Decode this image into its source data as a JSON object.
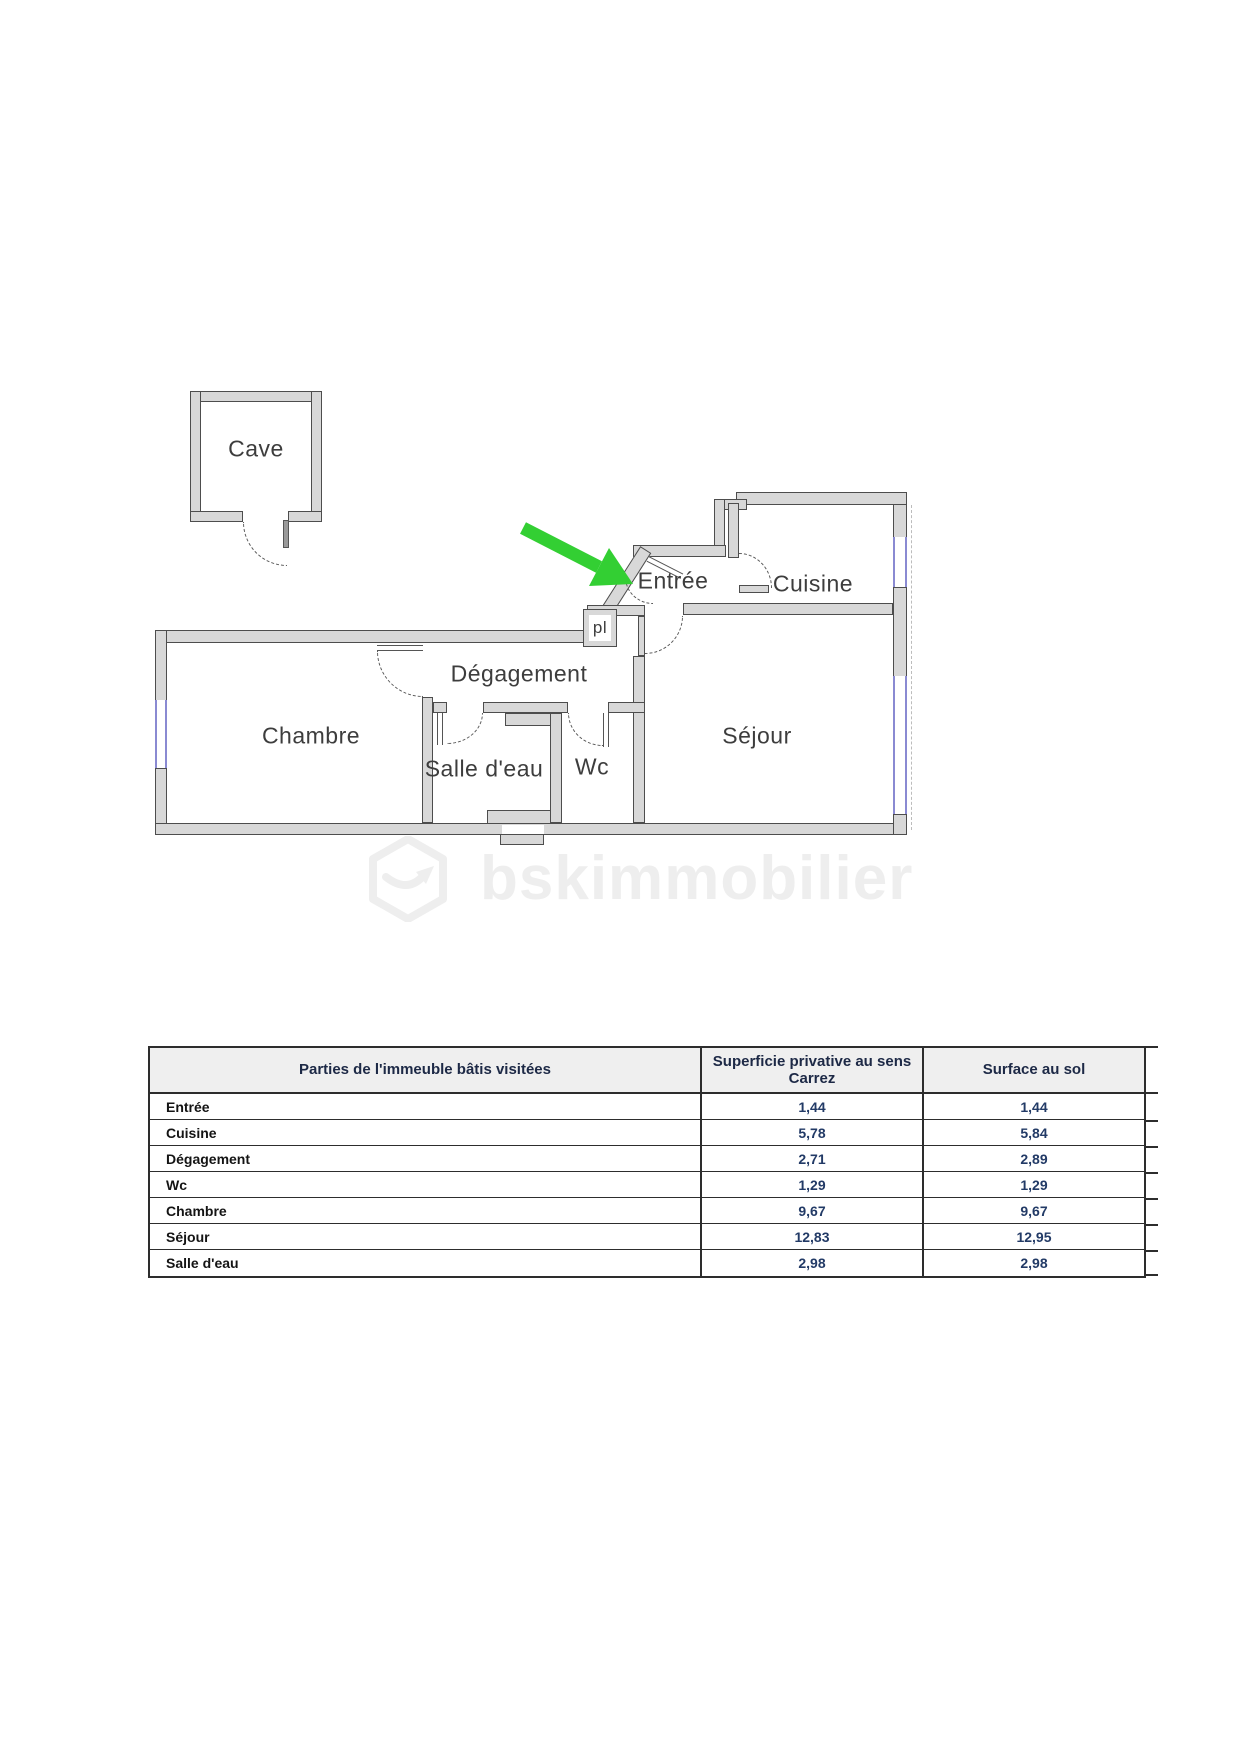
{
  "plan": {
    "labels": {
      "cave": "Cave",
      "entree": "Entrée",
      "cuisine": "Cuisine",
      "degagement": "Dégagement",
      "chambre": "Chambre",
      "salle_deau": "Salle d'eau",
      "wc": "Wc",
      "sejour": "Séjour",
      "placard": "pl"
    },
    "entry_arrow_color": "#33cf33",
    "window_color": "#8a8ad2",
    "wall_color": "#d8d8d8",
    "watermark_text": "bskimmobilier"
  },
  "table": {
    "col1_header": "Parties de l'immeuble bâtis visitées",
    "col2_header": "Superficie privative au sens Carrez",
    "col3_header": "Surface au sol",
    "rows": [
      {
        "label": "Entrée",
        "carrez": "1,44",
        "sol": "1,44"
      },
      {
        "label": "Cuisine",
        "carrez": "5,78",
        "sol": "5,84"
      },
      {
        "label": "Dégagement",
        "carrez": "2,71",
        "sol": "2,89"
      },
      {
        "label": "Wc",
        "carrez": "1,29",
        "sol": "1,29"
      },
      {
        "label": "Chambre",
        "carrez": "9,67",
        "sol": "9,67"
      },
      {
        "label": "Séjour",
        "carrez": "12,83",
        "sol": "12,95"
      },
      {
        "label": "Salle d'eau",
        "carrez": "2,98",
        "sol": "2,98"
      }
    ]
  }
}
